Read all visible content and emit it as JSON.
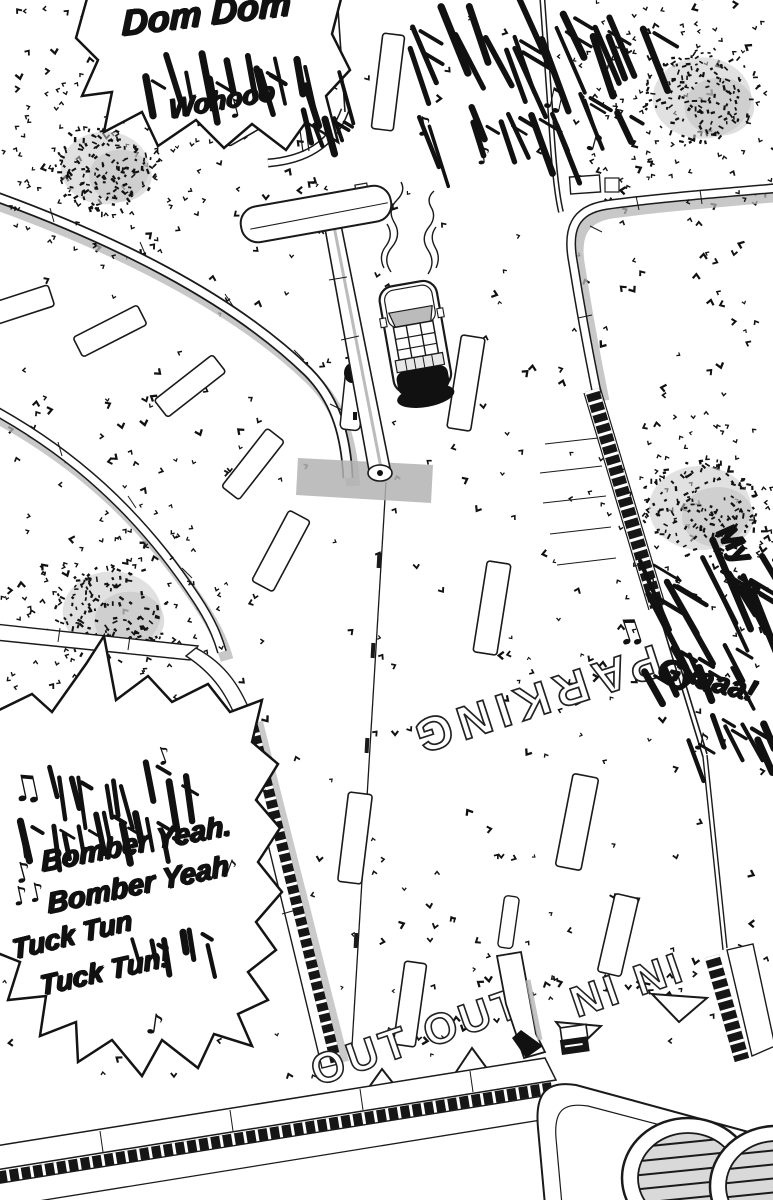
{
  "panel": {
    "description": "Overhead manga view of a car driving toward a PARKING lot entrance"
  },
  "sfx": {
    "top_left": {
      "dom_dom": "Dom Dom",
      "kana_engine": "ギュワワワワッ",
      "wohooo": "Wohooo",
      "note": "♪",
      "kana_ga": "ガッ"
    },
    "top_right": {
      "kana_row_a": "ルルルルルル",
      "kana_row_b": "テレテレテレ",
      "note_1": "♪",
      "note_2": "♫",
      "note_3": "♪",
      "note_4": "♪"
    },
    "right": {
      "my": "My",
      "kana_row_a": "ズズダダダ",
      "kana_row_b": "ズッチャッ",
      "gyaaa": "Gyaaa!",
      "kana_row_c": "ガガッ",
      "note_1": "♫",
      "note_2": "♪"
    },
    "bottom_left": {
      "note_1": "♫",
      "note_2": "♪",
      "kana_line_1": "チャ〜ラ〜ラ〜",
      "kana_line_2": "チャララ〜ラ〜ラ〜",
      "note_3": "♪",
      "bomber_1": "Bomber Yeah.",
      "note_4": "♪",
      "note_5": "♪♪",
      "bomber_2": "Bomber Yeah",
      "tuck_1": "Tuck Tun",
      "kana_tuck": "ガガガッ",
      "tuck_2": "Tuck Tun!",
      "note_6": "♪"
    }
  },
  "road_markings": {
    "parking": "PARKING",
    "out": "OUT OUT",
    "in_lanes": "IN IN"
  },
  "colors": {
    "ink": "#1a1a1a",
    "paper": "#ffffff",
    "shadow": "#b5b5b5",
    "tone": "#d9d9d9"
  }
}
